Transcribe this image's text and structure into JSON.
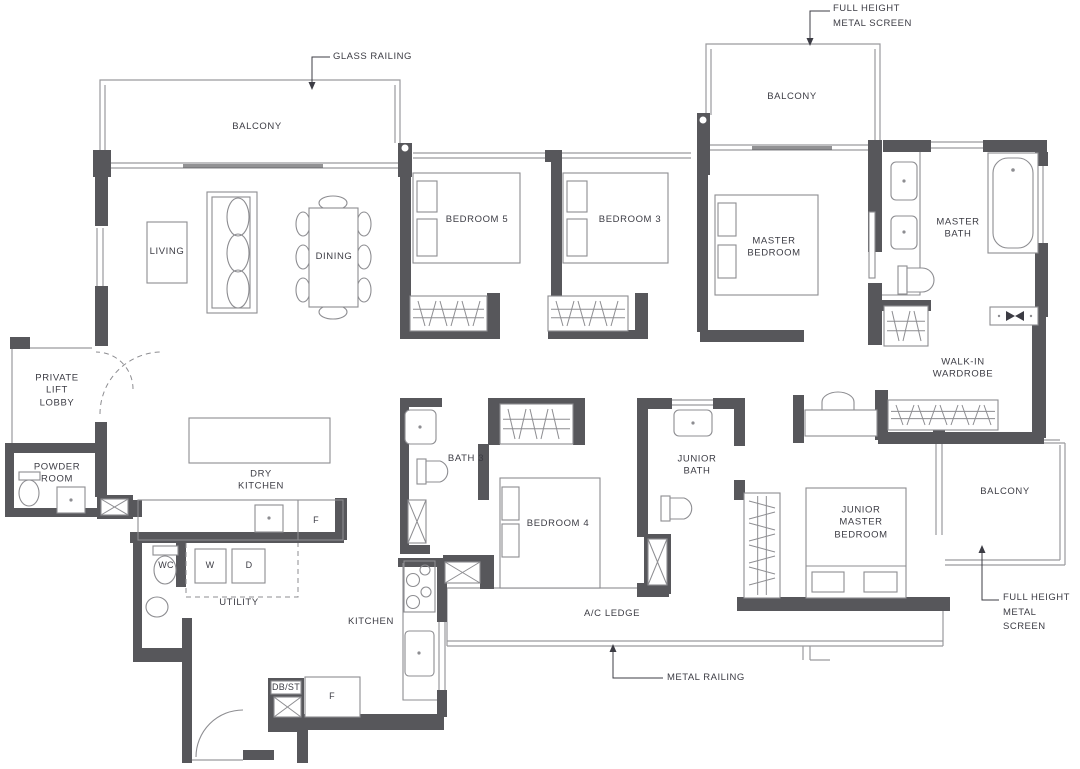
{
  "title": "Residential unit floor plan",
  "colors": {
    "wall": "#57575b",
    "line": "#9a9a9e",
    "furniture_line": "#8d8d91",
    "text": "#3c3c44",
    "background": "#ffffff"
  },
  "rooms": {
    "balcony_top_left": "BALCONY",
    "balcony_top_right": "BALCONY",
    "balcony_right": "BALCONY",
    "living": "LIVING",
    "dining": "DINING",
    "bedroom5": "BEDROOM 5",
    "bedroom3": "BEDROOM 3",
    "master_bedroom": "MASTER\nBEDROOM",
    "master_bath": "MASTER\nBATH",
    "walk_in_wardrobe": "WALK-IN\nWARDROBE",
    "private_lift_lobby": "PRIVATE\nLIFT\nLOBBY",
    "powder_room": "POWDER\nROOM",
    "dry_kitchen": "DRY\nKITCHEN",
    "utility": "UTILITY",
    "kitchen": "KITCHEN",
    "bath3": "BATH 3",
    "bedroom4": "BEDROOM 4",
    "junior_bath": "JUNIOR\nBATH",
    "junior_master_bedroom": "JUNIOR\nMASTER\nBEDROOM",
    "ac_ledge": "A/C LEDGE"
  },
  "fixtures": {
    "wc": "WC",
    "washer": "W",
    "dryer": "D",
    "fridge_dry_kitchen": "F",
    "fridge_kitchen": "F",
    "db_st": "DB/ST"
  },
  "annotations": {
    "full_height_metal_screen_top": "FULL HEIGHT\nMETAL SCREEN",
    "glass_railing": "GLASS RAILING",
    "full_height_metal_screen_bottom": "FULL HEIGHT\nMETAL SCREEN",
    "metal_railing": "METAL RAILING"
  }
}
